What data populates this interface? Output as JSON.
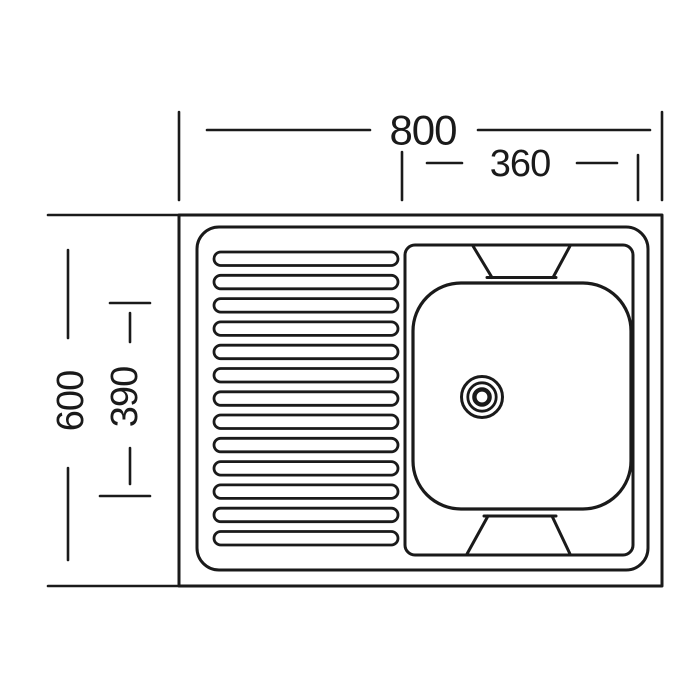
{
  "drawing": {
    "kind": "kitchen-sink-top-view-technical-drawing",
    "background_color": "#ffffff",
    "line_color": "#1a1a1a",
    "dimensions": {
      "overall_width_label": "800",
      "bowl_width_label": "360",
      "overall_depth_label": "600",
      "bowl_depth_label": "390"
    },
    "drainboard": {
      "rib_count": 13
    }
  }
}
